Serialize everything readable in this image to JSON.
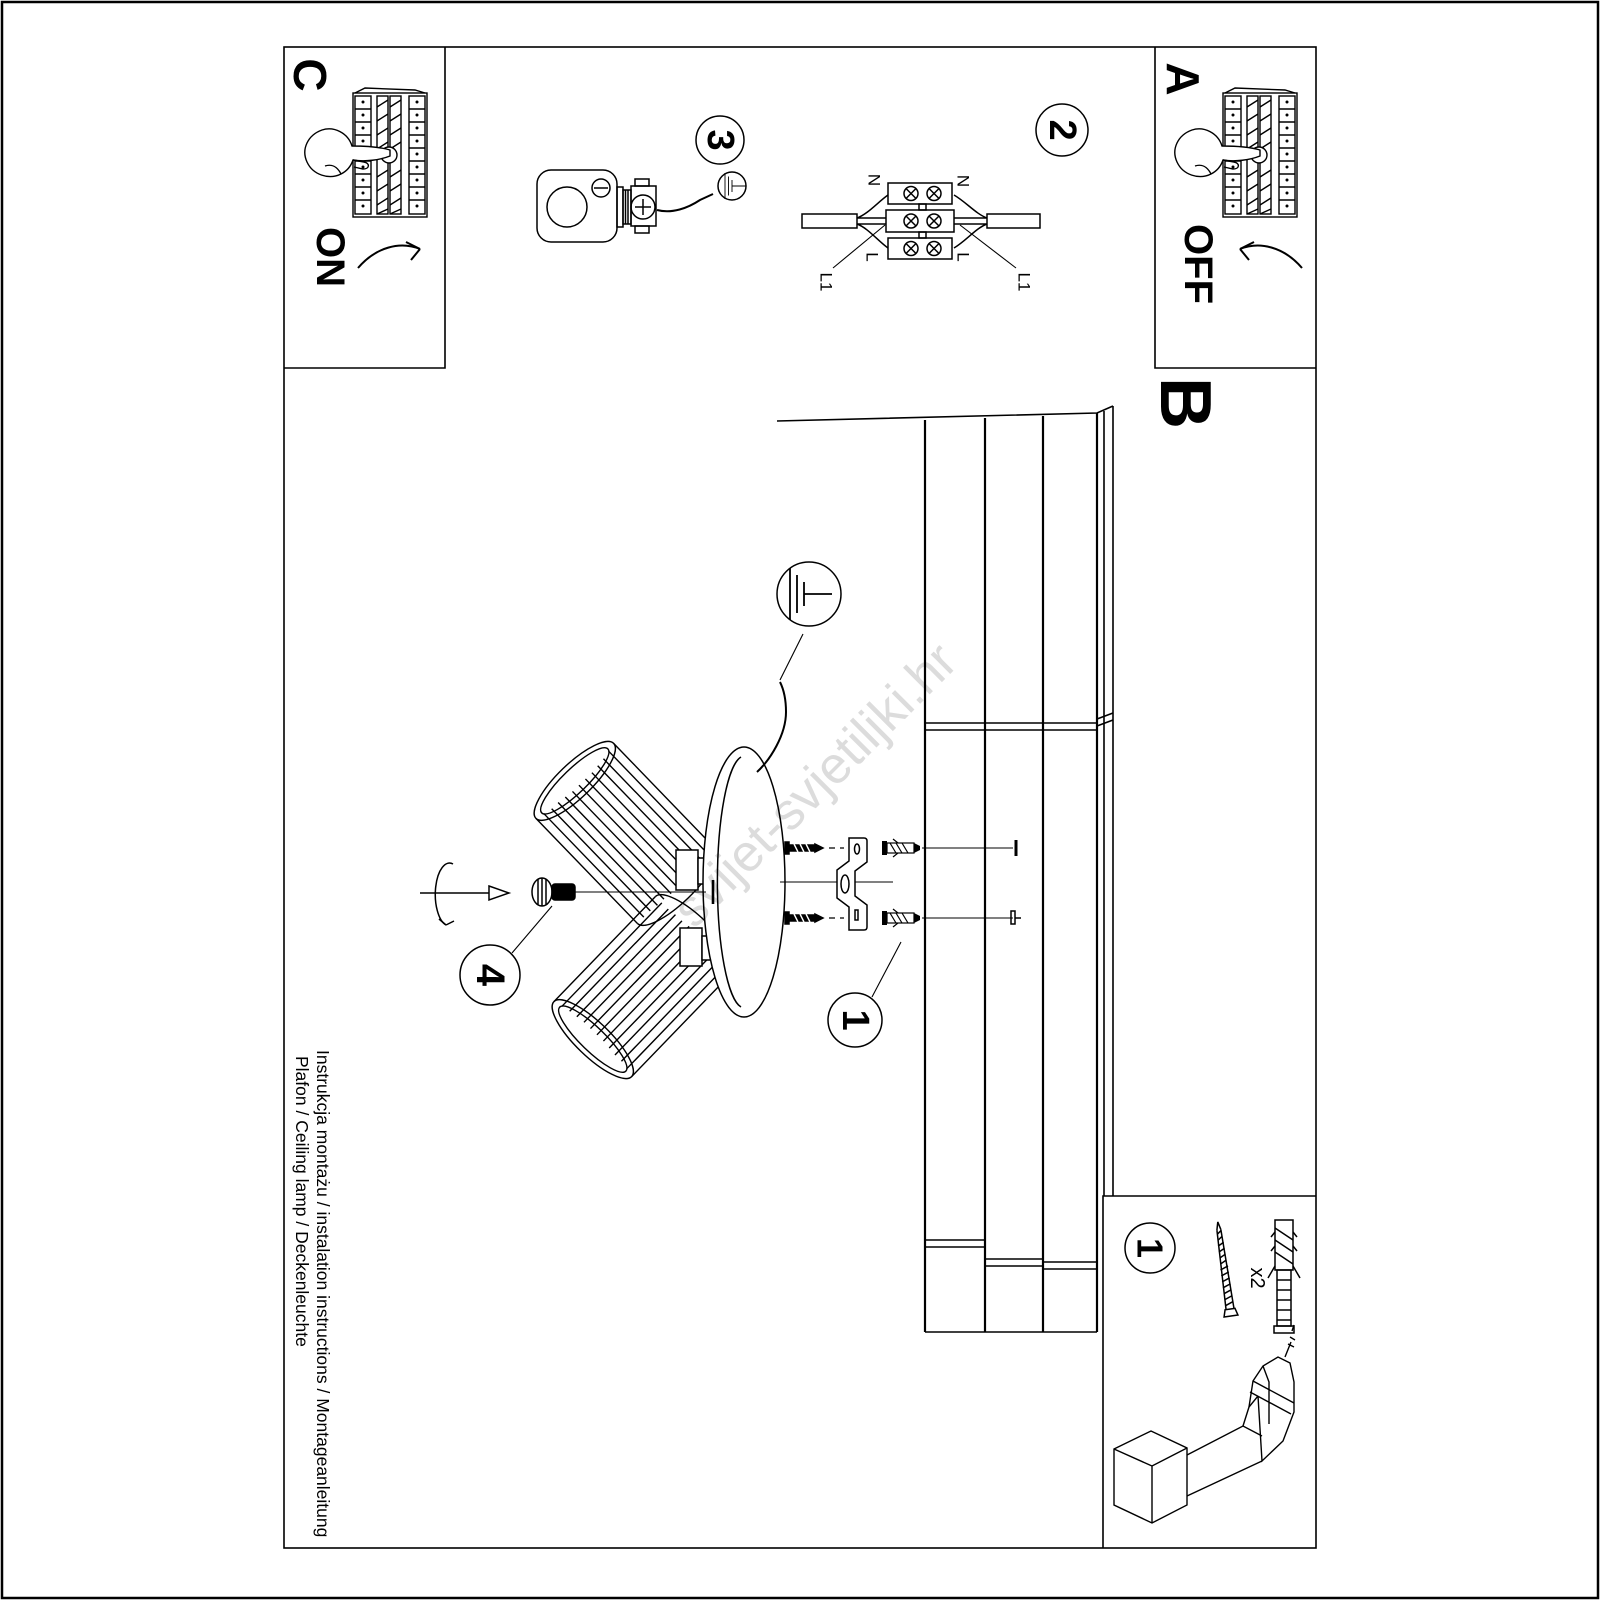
{
  "sheet": {
    "watermark": "svijet-svjetiljki.hr",
    "footer": {
      "line1": "Instrukcja montażu / instalation instructions / Montageanleitung",
      "line2": "Plafon / Ceiling lamp / Deckenleuchte"
    }
  },
  "panels": {
    "a": {
      "label": "A",
      "switch_state": "OFF"
    },
    "b": {
      "label": "B"
    },
    "c": {
      "label": "C",
      "switch_state": "ON"
    }
  },
  "steps": {
    "step1": "1",
    "step2": "2",
    "step3": "3",
    "step4": "4"
  },
  "wiring_diagram": {
    "neutral_left": "N",
    "neutral_right": "N",
    "live_left": "L",
    "live_right": "L",
    "switched_left": "L1",
    "switched_right": "L1"
  },
  "parts_box": {
    "step": "1",
    "anchor_quantity": "x2"
  },
  "colors": {
    "line": "#000000",
    "background": "#ffffff",
    "watermark": "#c9c9c9"
  }
}
